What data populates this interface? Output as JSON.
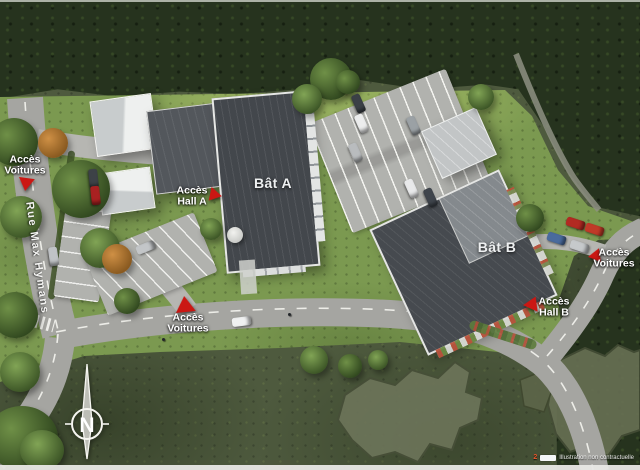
{
  "plan": {
    "street_name": "Rue Max Hymans",
    "buildings": {
      "a": "Bât A",
      "b": "Bât B"
    },
    "access": {
      "cars_left": "Accès Voitures",
      "hall_a": "Accès Hall A",
      "cars_bottom": "Accès Voitures",
      "cars_right": "Accès Voitures",
      "hall_b": "Accès Hall B"
    },
    "compass": {
      "north": "N"
    },
    "footer": {
      "page": "2",
      "disclaimer": "Illustration non contractuelle"
    },
    "colors": {
      "marker_red": "#cb1713",
      "roof_dark": "#464a4f",
      "lawn_green": "#7b9950",
      "road_grey": "#a5a5a1",
      "forest_green": "#26331e"
    }
  }
}
